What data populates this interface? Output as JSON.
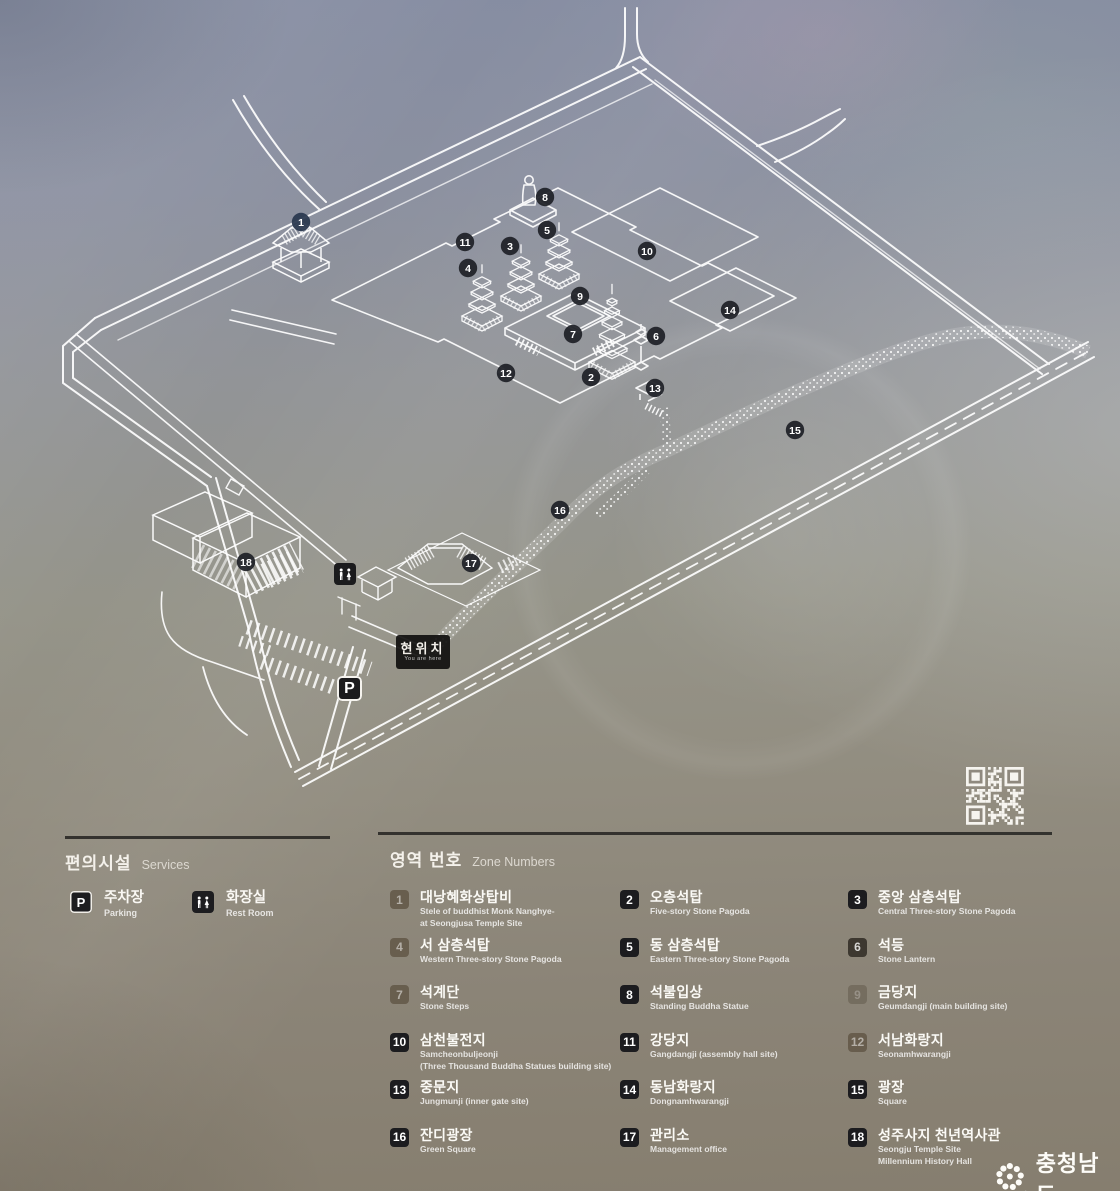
{
  "map": {
    "current_location": {
      "ko": "현위치",
      "en": "You are here"
    },
    "parking_badge": "P",
    "markers": [
      {
        "n": "1",
        "x": 301,
        "y": 222
      },
      {
        "n": "2",
        "x": 591,
        "y": 377
      },
      {
        "n": "3",
        "x": 510,
        "y": 246
      },
      {
        "n": "4",
        "x": 468,
        "y": 268
      },
      {
        "n": "5",
        "x": 547,
        "y": 230
      },
      {
        "n": "6",
        "x": 656,
        "y": 336
      },
      {
        "n": "7",
        "x": 573,
        "y": 334
      },
      {
        "n": "8",
        "x": 545,
        "y": 197
      },
      {
        "n": "9",
        "x": 580,
        "y": 296
      },
      {
        "n": "10",
        "x": 647,
        "y": 251
      },
      {
        "n": "11",
        "x": 465,
        "y": 242
      },
      {
        "n": "12",
        "x": 506,
        "y": 373
      },
      {
        "n": "13",
        "x": 655,
        "y": 388
      },
      {
        "n": "14",
        "x": 730,
        "y": 310
      },
      {
        "n": "15",
        "x": 795,
        "y": 430
      },
      {
        "n": "16",
        "x": 560,
        "y": 510
      },
      {
        "n": "17",
        "x": 471,
        "y": 563
      },
      {
        "n": "18",
        "x": 246,
        "y": 562
      }
    ]
  },
  "legend": {
    "services": {
      "title_ko": "편의시설",
      "title_en": "Services",
      "items": [
        {
          "icon": "parking-icon",
          "badge": "P",
          "ko": "주차장",
          "en": "Parking"
        },
        {
          "icon": "restroom-icon",
          "ko": "화장실",
          "en": "Rest Room"
        }
      ]
    },
    "zones": {
      "title_ko": "영역 번호",
      "title_en": "Zone Numbers",
      "items": [
        {
          "n": "1",
          "style": "faded",
          "ko": "대낭혜화상탑비",
          "en": [
            "Stele of buddhist Monk Nanghye-",
            "at Seongjusa Temple Site"
          ]
        },
        {
          "n": "2",
          "style": "dark",
          "ko": "오층석탑",
          "en": [
            "Five-story Stone Pagoda"
          ]
        },
        {
          "n": "3",
          "style": "dark",
          "ko": "중앙 삼층석탑",
          "en": [
            "Central Three-story Stone Pagoda"
          ]
        },
        {
          "n": "4",
          "style": "faded",
          "ko": "서 삼층석탑",
          "en": [
            "Western Three-story Stone Pagoda"
          ]
        },
        {
          "n": "5",
          "style": "dark",
          "ko": "동 삼층석탑",
          "en": [
            "Eastern Three-story Stone Pagoda"
          ]
        },
        {
          "n": "6",
          "style": "dim",
          "ko": "석등",
          "en": [
            "Stone Lantern"
          ]
        },
        {
          "n": "7",
          "style": "faded",
          "ko": "석계단",
          "en": [
            "Stone Steps"
          ]
        },
        {
          "n": "8",
          "style": "dark",
          "ko": "석불입상",
          "en": [
            "Standing Buddha Statue"
          ]
        },
        {
          "n": "9",
          "style": "ghost",
          "ko": "금당지",
          "en": [
            "Geumdangji (main building site)"
          ]
        },
        {
          "n": "10",
          "style": "dark",
          "ko": "삼천불전지",
          "en": [
            "Samcheonbuljeonji",
            "(Three Thousand Buddha Statues building site)"
          ]
        },
        {
          "n": "11",
          "style": "dark",
          "ko": "강당지",
          "en": [
            "Gangdangji (assembly hall site)"
          ]
        },
        {
          "n": "12",
          "style": "faded",
          "ko": "서남화랑지",
          "en": [
            "Seonamhwarangji"
          ]
        },
        {
          "n": "13",
          "style": "dark",
          "ko": "중문지",
          "en": [
            "Jungmunji (inner gate site)"
          ]
        },
        {
          "n": "14",
          "style": "dark",
          "ko": "동남화랑지",
          "en": [
            "Dongnamhwarangji"
          ]
        },
        {
          "n": "15",
          "style": "dark",
          "ko": "광장",
          "en": [
            "Square"
          ]
        },
        {
          "n": "16",
          "style": "dark",
          "ko": "잔디광장",
          "en": [
            "Green Square"
          ]
        },
        {
          "n": "17",
          "style": "dark",
          "ko": "관리소",
          "en": [
            "Management office"
          ]
        },
        {
          "n": "18",
          "style": "dark",
          "ko": "성주사지 천년역사관",
          "en": [
            "Seongju Temple Site",
            "Millennium History Hall"
          ]
        }
      ]
    }
  },
  "footer": {
    "org": "충청남도"
  }
}
